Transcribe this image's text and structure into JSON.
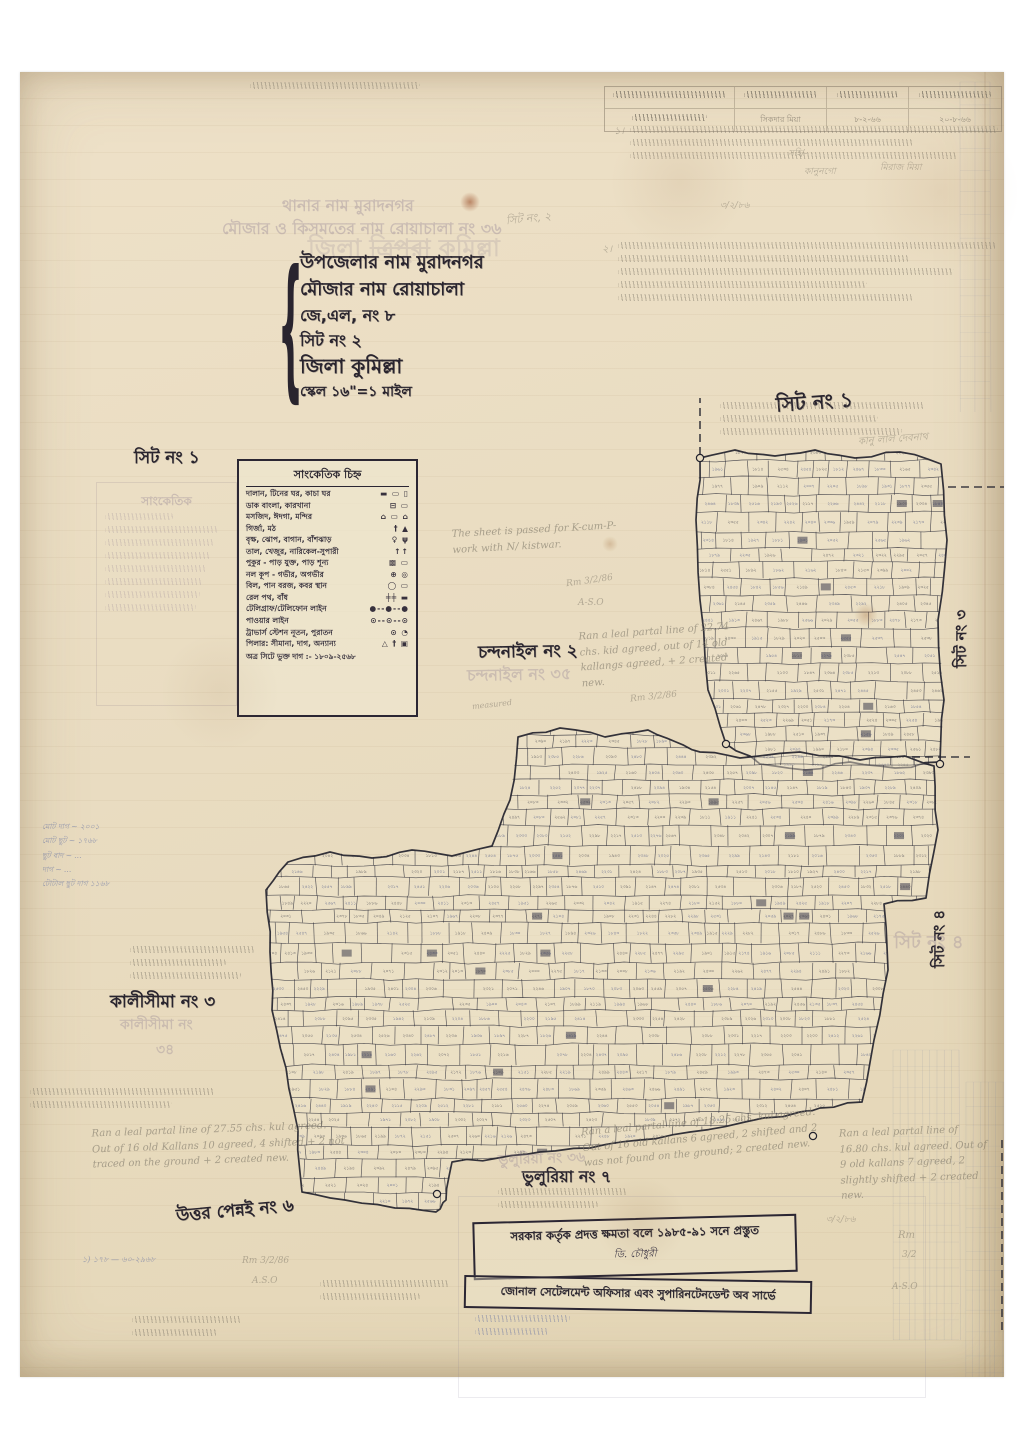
{
  "paper": {
    "bg": "#e9dcc1",
    "ink": "#29242e",
    "pencil": "#7d7668",
    "blue": "#5566a0",
    "faded": "#8e7d92"
  },
  "top_table": {
    "row2_c2": "সিকদার মিয়া",
    "row2_c3": "৮-২-৬৬",
    "row2_c4": "২০-৮-৬৬"
  },
  "title_block": {
    "faded_lines": [
      {
        "text": "থানার নাম মুরাদনগর",
        "x": 262,
        "y": 121,
        "size": 16
      },
      {
        "text": "মৌজার ও কিসমতের নাম রোয়াচালা নং ৩৬",
        "x": 202,
        "y": 144,
        "size": 16
      }
    ],
    "district_stamp": {
      "pre": "জিলা ",
      "struck": "ত্রিপুরা",
      "post": " কুমিল্লা",
      "x": 288,
      "y": 158,
      "size": 24
    },
    "lines": [
      {
        "text": "উপজেলার নাম মুরাদনগর",
        "x": 280,
        "y": 176,
        "size": 18
      },
      {
        "text": "মৌজার নাম রোয়াচালা",
        "x": 280,
        "y": 203,
        "size": 18
      },
      {
        "text": "জে,এল, নং ৮",
        "x": 280,
        "y": 231,
        "size": 16
      },
      {
        "text": "সিট নং ২",
        "x": 280,
        "y": 256,
        "size": 16
      },
      {
        "text": "জিলা  কুমিল্লা",
        "x": 280,
        "y": 280,
        "size": 20
      },
      {
        "text": "স্কেল ১৬\"=১ মাইল",
        "x": 280,
        "y": 308,
        "size": 14
      }
    ]
  },
  "legend": {
    "title": "সাংকেতিক চিহ্ন",
    "rows": [
      {
        "label": "দালান, টিনের ঘর, কাচা ঘর",
        "sym": "▬ ▭ ▯"
      },
      {
        "label": "ডাক বাংলা, কারখানা",
        "sym": "⊟ ▭"
      },
      {
        "label": "মসজিদ, ঈদগা, মন্দির",
        "sym": "⌂ ▭ ⌂"
      },
      {
        "label": "গির্জা, মঠ",
        "sym": "† ▲"
      },
      {
        "label": "বৃক্ষ, ঝোপ, বাগান, বাঁশঝাড়",
        "sym": "♀ ψ"
      },
      {
        "label": "তাল, খেজুর, নারিকেল-সুপারী",
        "sym": "↑↑"
      },
      {
        "label": "পুকুর - পাড় যুক্ত, পাড় শূন্য",
        "sym": "▩ ▭"
      },
      {
        "label": "নল কূপ - গভীর, অগভীর",
        "sym": "⊕ ◎"
      },
      {
        "label": "বিল, পান বরজ, কবর স্থান",
        "sym": "◯ ▭"
      },
      {
        "label": "রেল পথ, বাঁধ",
        "sym": "╪╪ ▬"
      },
      {
        "label": "টেলিগ্রাফ/টেলিফোন লাইন",
        "sym": "●--●--●"
      },
      {
        "label": "পাওয়ার লাইন",
        "sym": "⊙--⊙--⊙"
      },
      {
        "label": "ট্রাভার্স স্টেশন নূতন, পুরাতন",
        "sym": "⊙ ◔"
      },
      {
        "label": "পিলার: সীমানা, দাগ, অন্যান্য",
        "sym": "△ † ▣"
      }
    ],
    "footer": "অত্র সিটে ভুক্ত দাগ :- ১৮০৯-২৫৬৮"
  },
  "ghost_legend": {
    "title": "সাংকেতিক"
  },
  "sheet_labels": [
    {
      "text": "সিট নং ১",
      "x": 114,
      "y": 373,
      "size": 17
    },
    {
      "text": "সিট নং ১",
      "x": 756,
      "y": 316,
      "size": 20,
      "rot": -4
    },
    {
      "text": "চন্দনাইল নং ২",
      "x": 458,
      "y": 567,
      "size": 17,
      "rot": -1
    },
    {
      "text": "চন্দনাইল নং ৩৫",
      "x": 447,
      "y": 590,
      "size": 16,
      "faded": 1,
      "rot": -1
    },
    {
      "text": "কালীসীমা নং ৩",
      "x": 90,
      "y": 917,
      "size": 17
    },
    {
      "text": "কালীসীমা নং",
      "x": 100,
      "y": 941,
      "size": 14,
      "faded": 1
    },
    {
      "text": "৩৪",
      "x": 136,
      "y": 966,
      "size": 14,
      "faded": 1
    },
    {
      "text": "উত্তর পেন্নই নং ৬",
      "x": 156,
      "y": 1126,
      "size": 17,
      "rot": -5
    },
    {
      "text": "ভুলুরিয়া নং ৭",
      "x": 502,
      "y": 1092,
      "size": 16
    },
    {
      "text": "ভুলুরিয়া নং ৩৬",
      "x": 478,
      "y": 1075,
      "size": 14,
      "faded": 1,
      "rot": -2
    },
    {
      "text": "সিট নং ৩",
      "x": 928,
      "y": 538,
      "size": 15,
      "vert": 1
    },
    {
      "text": "সিট নং ৪",
      "x": 906,
      "y": 838,
      "size": 15,
      "vert": 1
    },
    {
      "text": "সিট নং ৪",
      "x": 874,
      "y": 856,
      "size": 18,
      "faded": 1
    }
  ],
  "english_notes": [
    {
      "text": "The sheet is passed for K-cum-P- work with N/ kistwar.",
      "x": 432,
      "y": 450,
      "w": 190,
      "rot": -3
    },
    {
      "text": "Ran a leal partal line of 22.74 chs. kid agreed, out of 14 old kallangs agreed, + 2 created new.",
      "x": 560,
      "y": 552,
      "w": 160,
      "rot": -4
    },
    {
      "text": "Ran a leal partal line of 27.55 chs. kul agreed. Out of 16 old Kallans 10 agreed, 4 shifted + 2 not traced on the ground + 2 created new.",
      "x": 72,
      "y": 1050,
      "w": 255,
      "rot": -2
    },
    {
      "text": "Ran a leal partal line of 18.25 chs. kul agreed. Out of 16 old kallans 6 agreed, 2 shifted and 2 was not found on the ground; 2 created new.",
      "x": 562,
      "y": 1042,
      "w": 255,
      "rot": -5
    },
    {
      "text": "Ran a leal partal line of 16.80 chs. kul agreed. Out of 9 old kallans 7 agreed, 2 slightly shifted + 2 created new.",
      "x": 820,
      "y": 1052,
      "w": 150,
      "rot": -2
    }
  ],
  "fragments": [
    {
      "text": "১।",
      "x": 594,
      "y": 52,
      "size": 10
    },
    {
      "text": "সহি/-",
      "x": 768,
      "y": 74,
      "size": 9
    },
    {
      "text": "কানুনগো",
      "x": 784,
      "y": 92,
      "size": 9
    },
    {
      "text": "মিরাজ মিয়া",
      "x": 860,
      "y": 88,
      "size": 9
    },
    {
      "text": "২।",
      "x": 582,
      "y": 170,
      "size": 10
    },
    {
      "text": "৩/২/৮৬",
      "x": 700,
      "y": 126,
      "size": 9
    },
    {
      "text": "সিট নং, ২",
      "x": 486,
      "y": 138,
      "size": 11,
      "rot": -6
    },
    {
      "text": "কানু লাল দেবনাথ",
      "x": 838,
      "y": 360,
      "size": 10,
      "rot": -4
    },
    {
      "text": "Rm 3/2/86",
      "x": 546,
      "y": 504,
      "size": 9,
      "rot": -8
    },
    {
      "text": "A-S.O",
      "x": 558,
      "y": 526,
      "size": 9
    },
    {
      "text": "measured",
      "x": 452,
      "y": 628,
      "size": 8,
      "rot": -6
    },
    {
      "text": "Rm 3/2/86",
      "x": 610,
      "y": 620,
      "size": 9,
      "rot": -6
    },
    {
      "text": "Rm 3/2/86",
      "x": 222,
      "y": 1184,
      "size": 9
    },
    {
      "text": "A.S.O",
      "x": 232,
      "y": 1204,
      "size": 9
    },
    {
      "text": "৩/২/৮৬",
      "x": 806,
      "y": 1140,
      "size": 9
    },
    {
      "text": "Rm",
      "x": 878,
      "y": 1158,
      "size": 10
    },
    {
      "text": "3/2",
      "x": 882,
      "y": 1178,
      "size": 9
    },
    {
      "text": "A-S.O",
      "x": 872,
      "y": 1210,
      "size": 9
    },
    {
      "text": "১) ১৭৮ — ৬০-২৯৬৮",
      "x": 62,
      "y": 1182,
      "size": 8,
      "blue": 1
    }
  ],
  "scribbles": [
    {
      "x": 230,
      "y": 10,
      "w": 170,
      "lines": 1
    },
    {
      "x": 610,
      "y": 54,
      "w": 368,
      "lines": 3
    },
    {
      "x": 598,
      "y": 170,
      "w": 378,
      "lines": 5
    },
    {
      "x": 700,
      "y": 330,
      "w": 205,
      "lines": 3
    },
    {
      "x": 110,
      "y": 874,
      "w": 125,
      "lines": 3
    },
    {
      "x": 10,
      "y": 1016,
      "w": 185,
      "lines": 2
    },
    {
      "x": 478,
      "y": 1116,
      "w": 130,
      "lines": 2
    },
    {
      "x": 300,
      "y": 1208,
      "w": 130,
      "lines": 2
    },
    {
      "x": 455,
      "y": 1243,
      "w": 95,
      "lines": 2,
      "blue": 1
    },
    {
      "x": 112,
      "y": 1244,
      "w": 110,
      "lines": 2
    }
  ],
  "margin_list": {
    "lines": [
      "মোট দাগ ~ ২০০১",
      "মোট ছুট ~ ১৭৬৮",
      "ছুট বাদ ~ …",
      "দাগ ~ …",
      "টোটাল ছুট দাগ ১১৬৮"
    ]
  },
  "stamp": {
    "line1": "সরকার কর্তৃক প্রদত্ত ক্ষমতা বলে ১৯৮৫-৯১ সনে প্রস্তুত",
    "sig": "ডি. চৌধুরী",
    "line2": "জোনাল সেটেলমেন্ট অফিসার এবং সুপারিনটেনডেন্ট অব সার্ভে"
  },
  "stains": [
    {
      "x": 450,
      "y": 130,
      "s": 10,
      "c": "rgba(146,64,26,0.55)"
    },
    {
      "x": 846,
      "y": 543,
      "s": 12,
      "c": "rgba(150,90,40,0.3)"
    },
    {
      "x": 590,
      "y": 472,
      "s": 8,
      "c": "rgba(150,90,40,0.25)"
    },
    {
      "x": 620,
      "y": 1150,
      "s": 46,
      "c": "rgba(140,100,60,0.12)"
    },
    {
      "x": 660,
      "y": 110,
      "s": 70,
      "c": "rgba(150,110,70,0.10)"
    },
    {
      "x": 200,
      "y": 620,
      "s": 60,
      "c": "rgba(140,100,60,0.08)"
    },
    {
      "x": 920,
      "y": 120,
      "s": 80,
      "c": "rgba(160,115,70,0.10)"
    }
  ],
  "map_sketch": {
    "plot_range": [
      1809,
      2568
    ],
    "ink": "#2e2e3a",
    "blue": "#3d4a80",
    "regions": [
      {
        "seed": 11,
        "points": [
          [
            680,
            386
          ],
          [
            715,
            378
          ],
          [
            755,
            384
          ],
          [
            795,
            378
          ],
          [
            835,
            386
          ],
          [
            880,
            380
          ],
          [
            921,
            392
          ],
          [
            927,
            468
          ],
          [
            918,
            548
          ],
          [
            924,
            628
          ],
          [
            920,
            690
          ],
          [
            875,
            696
          ],
          [
            830,
            690
          ],
          [
            785,
            698
          ],
          [
            740,
            692
          ],
          [
            706,
            672
          ],
          [
            688,
            618
          ],
          [
            680,
            528
          ],
          [
            676,
            448
          ]
        ]
      },
      {
        "seed": 23,
        "points": [
          [
            498,
            665
          ],
          [
            540,
            656
          ],
          [
            585,
            665
          ],
          [
            628,
            658
          ],
          [
            656,
            670
          ],
          [
            680,
            680
          ],
          [
            720,
            686
          ],
          [
            780,
            680
          ],
          [
            840,
            688
          ],
          [
            885,
            684
          ],
          [
            914,
            694
          ],
          [
            918,
            758
          ],
          [
            906,
            826
          ],
          [
            864,
            832
          ],
          [
            868,
            898
          ],
          [
            854,
            968
          ],
          [
            842,
            1030
          ],
          [
            800,
            1036
          ],
          [
            780,
            1040
          ],
          [
            725,
            1050
          ],
          [
            670,
            1060
          ],
          [
            620,
            1068
          ],
          [
            570,
            1076
          ],
          [
            520,
            1080
          ],
          [
            478,
            1086
          ],
          [
            432,
            1090
          ],
          [
            426,
            1128
          ],
          [
            416,
            1140
          ],
          [
            375,
            1136
          ],
          [
            325,
            1128
          ],
          [
            282,
            1120
          ],
          [
            278,
            1058
          ],
          [
            266,
            996
          ],
          [
            252,
            938
          ],
          [
            250,
            880
          ],
          [
            246,
            818
          ],
          [
            268,
            790
          ],
          [
            310,
            780
          ],
          [
            352,
            786
          ],
          [
            392,
            778
          ],
          [
            432,
            784
          ],
          [
            472,
            774
          ],
          [
            490,
            728
          ]
        ]
      }
    ],
    "circles": [
      [
        680,
        386
      ],
      [
        706,
        672
      ],
      [
        920,
        692
      ],
      [
        417,
        1122
      ],
      [
        793,
        1064
      ]
    ],
    "dashes": [
      [
        [
          680,
          383
        ],
        [
          680,
          326
        ]
      ],
      [
        [
          928,
          415
        ],
        [
          986,
          415
        ]
      ],
      [
        [
          892,
          685
        ],
        [
          950,
          685
        ]
      ],
      [
        [
          982,
          1068
        ],
        [
          982,
          1262
        ]
      ]
    ],
    "bleed_strips": [
      {
        "x": 873,
        "y": 978,
        "w": 66,
        "h": 290,
        "cols": 9
      },
      {
        "x": 946,
        "y": 1010,
        "w": 52,
        "h": 330,
        "cols": 7
      },
      {
        "x": 940,
        "y": 10,
        "w": 30,
        "h": 330,
        "cols": 2
      }
    ]
  }
}
